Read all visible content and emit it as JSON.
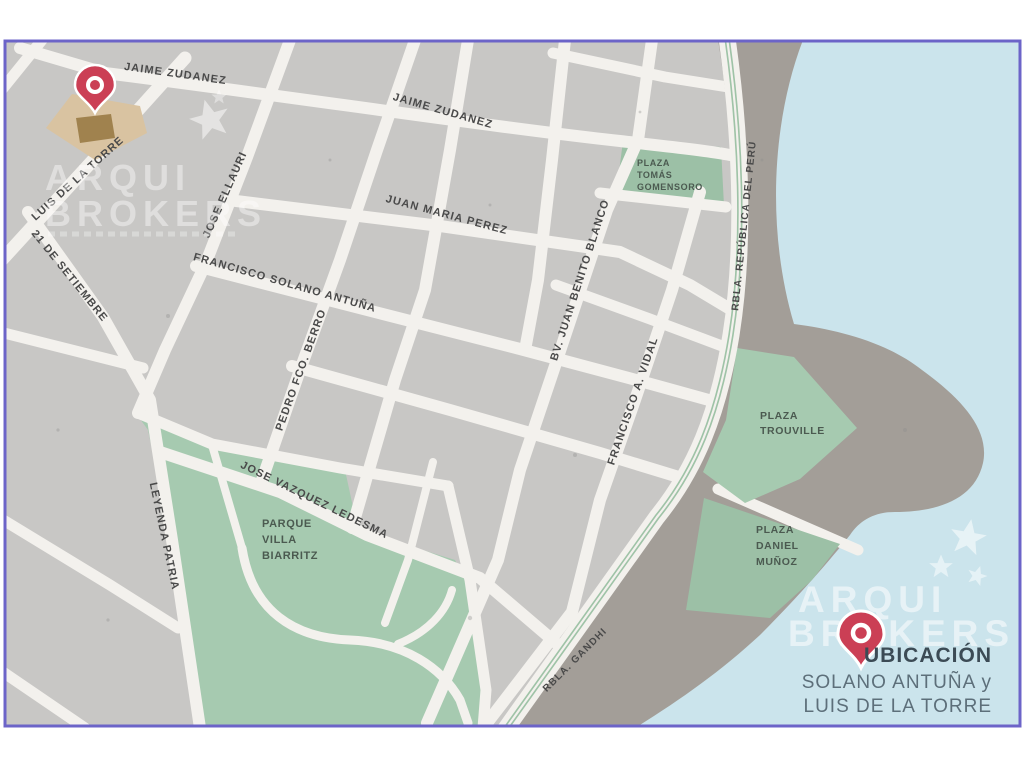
{
  "colors": {
    "border": "#6c64c8",
    "land": "#c8c7c5",
    "street": "#f3f1ed",
    "water": "#cbe4ec",
    "coast": "#a39e98",
    "park": "#a6cab0",
    "plaza_green": "#9cc0a6",
    "rambla_median": "#9fc3a7",
    "pin_red": "#cb3f55",
    "building_tan": "#d9c3a1",
    "building_brown": "#a0824e",
    "watermark_white": "#ffffff"
  },
  "street_labels": [
    {
      "id": "jaime-zudanez-1",
      "text": "JAIME ZUDANEZ",
      "x": 175,
      "y": 77,
      "rot": 8
    },
    {
      "id": "jaime-zudanez-2",
      "text": "JAIME ZUDANEZ",
      "x": 442,
      "y": 114,
      "rot": 16
    },
    {
      "id": "juan-maria-perez",
      "text": "JUAN MARIA PEREZ",
      "x": 446,
      "y": 218,
      "rot": 15
    },
    {
      "id": "francisco-solano-antuna",
      "text": "FRANCISCO SOLANO ANTUÑA",
      "x": 284,
      "y": 286,
      "rot": 16
    },
    {
      "id": "luis-de-la-torre",
      "text": "LUIS DE LA TORRE",
      "x": 80,
      "y": 181,
      "rot": -42
    },
    {
      "id": "veintiuno-de-setiembre",
      "text": "21 DE SETIEMBRE",
      "x": 67,
      "y": 278,
      "rot": 51
    },
    {
      "id": "jose-ellauri",
      "text": "JOSE ELLAURI",
      "x": 228,
      "y": 196,
      "rot": -66
    },
    {
      "id": "pedro-fco-berro",
      "text": "PEDRO FCO. BERRO",
      "x": 304,
      "y": 371,
      "rot": -70
    },
    {
      "id": "bv-juan-benito-blanco",
      "text": "BV. JUAN BENITO BLANCO",
      "x": 583,
      "y": 281,
      "rot": -72
    },
    {
      "id": "francisco-a-vidal",
      "text": "FRANCISCO A. VIDAL",
      "x": 636,
      "y": 402,
      "rot": -71
    },
    {
      "id": "rbla-republica-del-peru",
      "text": "RBLA. REPÚBLICA DEL PERÚ",
      "x": 747,
      "y": 226,
      "rot": -84,
      "small": true
    },
    {
      "id": "rbla-gandhi",
      "text": "RBLA. GANDHI",
      "x": 577,
      "y": 662,
      "rot": -45,
      "small": true
    },
    {
      "id": "jose-vazquez-ledesma",
      "text": "JOSE VAZQUEZ LEDESMA",
      "x": 313,
      "y": 503,
      "rot": 26
    },
    {
      "id": "leyenda-patria",
      "text": "LEYENDA PATRIA",
      "x": 161,
      "y": 537,
      "rot": 78
    }
  ],
  "plaza_labels": [
    {
      "id": "plaza-tomas-gomensoro",
      "x": 637,
      "size": 9,
      "lines": [
        "PLAZA",
        "TOMÁS",
        "GOMENSORO"
      ],
      "ys": [
        166,
        178,
        190
      ]
    },
    {
      "id": "plaza-trouville",
      "x": 760,
      "size": 10.5,
      "lines": [
        "PLAZA",
        "TROUVILLE"
      ],
      "ys": [
        419,
        434
      ]
    },
    {
      "id": "plaza-daniel-munoz",
      "x": 756,
      "size": 10.5,
      "lines": [
        "PLAZA",
        "DANIEL",
        "MUÑOZ"
      ],
      "ys": [
        533,
        549,
        565
      ]
    },
    {
      "id": "parque-villa-biarritz",
      "x": 262,
      "size": 11,
      "lines": [
        "PARQUE",
        "VILLA",
        "BIARRITZ"
      ],
      "ys": [
        527,
        543,
        559
      ]
    }
  ],
  "watermark": {
    "brand_line1": "ARQUI",
    "brand_line2": "BROKERS"
  },
  "legend": {
    "title": "UBICACIÓN",
    "subtitle_line1": "SOLANO ANTUÑA y",
    "subtitle_line2": "LUIS DE LA TORRE"
  }
}
